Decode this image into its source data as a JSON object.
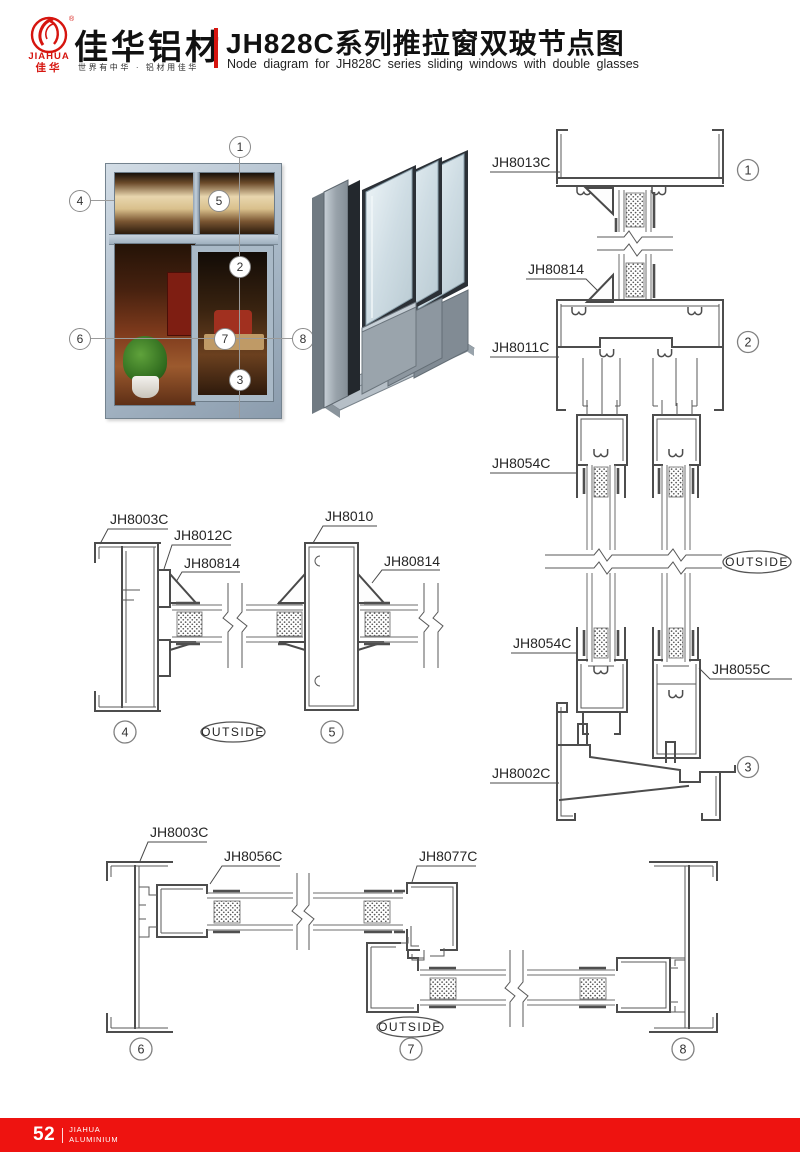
{
  "header": {
    "logo": {
      "brand_text": "JIAHUA",
      "brand_cn": "佳华",
      "registered": "®",
      "company_cn": "佳华铝材",
      "slogan": "世界有中华 · 铝材用佳华"
    },
    "title_cn": "JH828C系列推拉窗双玻节点图",
    "title_en": "Node diagram for JH828C series sliding windows with double glasses"
  },
  "window_figure": {
    "callouts": [
      "1",
      "2",
      "3",
      "4",
      "5",
      "6",
      "7",
      "8"
    ]
  },
  "sections": {
    "vertical": {
      "labels": {
        "top_frame": "JH8013C",
        "glazing_bead": "JH80814",
        "transom": "JH8011C",
        "sash_top": "JH8054C",
        "sash_bottom": "JH8054C",
        "sash_bottom_right": "JH8055C",
        "sill": "JH8002C"
      },
      "outside": "OUTSIDE",
      "callouts": {
        "top": "1",
        "middle": "2",
        "bottom": "3"
      }
    },
    "horizontal_mid": {
      "labels": {
        "frame": "JH8003C",
        "sash_adapter": "JH8012C",
        "bead_left": "JH80814",
        "mullion": "JH8010",
        "bead_right": "JH80814"
      },
      "outside": "OUTSIDE",
      "callouts": {
        "left": "4",
        "right": "5"
      }
    },
    "horizontal_bottom": {
      "labels": {
        "frame": "JH8003C",
        "sash": "JH8056C",
        "interlock": "JH8077C"
      },
      "outside": "OUTSIDE",
      "callouts": {
        "left": "6",
        "middle": "7",
        "right": "8"
      }
    }
  },
  "footer": {
    "page_number": "52",
    "brand_line1": "JIAHUA",
    "brand_line2": "ALUMINIUM"
  },
  "colors": {
    "brand_red": "#d6150f",
    "footer_red": "#ee1310",
    "cad_line": "#4d4d4d"
  }
}
